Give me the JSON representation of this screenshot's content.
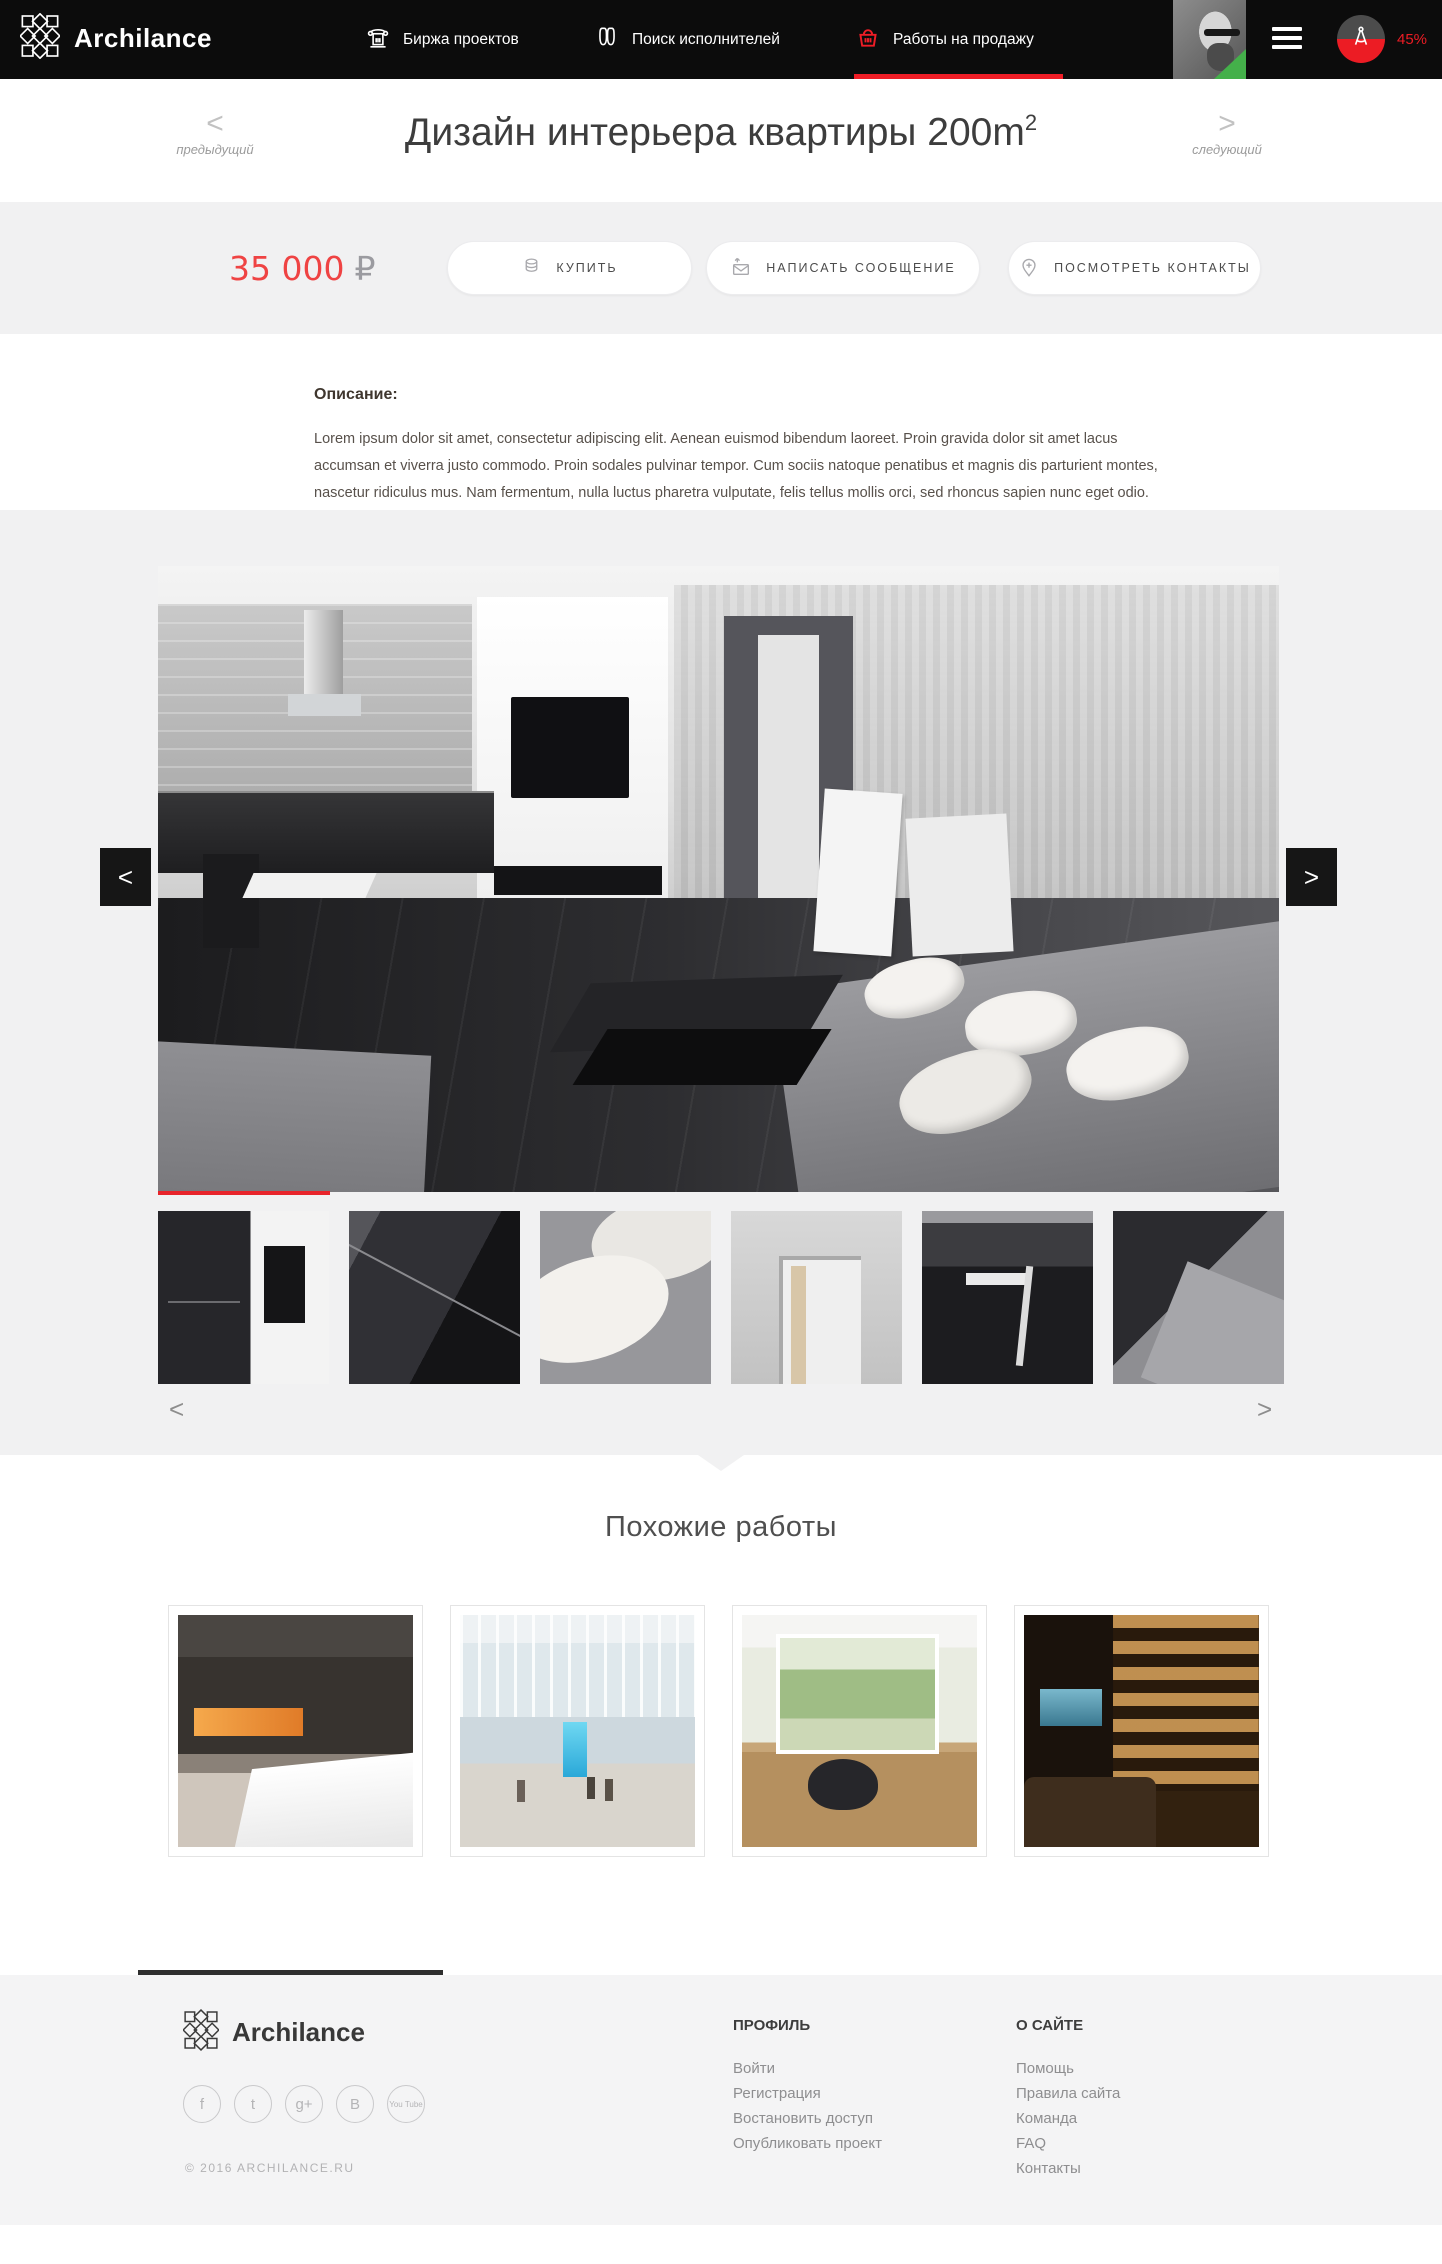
{
  "colors": {
    "accent_red": "#f01d26",
    "price_red": "#ef4343",
    "header_bg": "#0c0c0c",
    "section_gray": "#f1f1f2",
    "footer_gray": "#f4f4f5"
  },
  "header": {
    "brand": "Archilance",
    "nav": [
      {
        "label": "Биржа проектов",
        "icon": "bank-icon"
      },
      {
        "label": "Поиск исполнителей",
        "icon": "binoculars-icon"
      },
      {
        "label": "Работы на продажу",
        "icon": "basket-icon",
        "active": true
      }
    ],
    "progress_badge": "45%"
  },
  "title_bar": {
    "prev_arrow": "<",
    "prev_label": "предыдущий",
    "title": "Дизайн интерьера квартиры 200m",
    "title_sup": "2",
    "next_arrow": ">",
    "next_label": "следующий"
  },
  "purchase": {
    "price": "35 000",
    "currency": "₽",
    "buy_label": "КУПИТЬ",
    "message_label": "НАПИСАТЬ СООБЩЕНИЕ",
    "contacts_label": "ПОСМОТРЕТЬ КОНТАКТЫ"
  },
  "description": {
    "heading": "Описание:",
    "body": "Lorem ipsum dolor sit amet, consectetur adipiscing elit. Aenean euismod bibendum laoreet. Proin gravida dolor sit amet lacus accumsan et viverra justo commodo. Proin sodales pulvinar tempor. Cum sociis natoque penatibus et magnis dis parturient montes, nascetur ridiculus mus. Nam fermentum, nulla luctus pharetra vulputate, felis tellus mollis orci, sed rhoncus sapien nunc eget odio."
  },
  "gallery": {
    "prev_arrow": "<",
    "next_arrow": ">",
    "thumb_prev": "<",
    "thumb_next": ">",
    "thumbnails": [
      "kitchen-detail",
      "coffee-table-detail",
      "sofa-pillows-detail",
      "doorway-detail",
      "dining-area-detail",
      "sofa-floor-detail"
    ]
  },
  "similar": {
    "heading": "Похожие работы",
    "cards": [
      "fireplace-interior",
      "mall-atrium",
      "bright-living-room",
      "home-library"
    ]
  },
  "footer": {
    "brand": "Archilance",
    "copyright": "© 2016 ARCHILANCE.RU",
    "social": [
      {
        "name": "facebook",
        "glyph": "f"
      },
      {
        "name": "twitter",
        "glyph": "t"
      },
      {
        "name": "google-plus",
        "glyph": "g+"
      },
      {
        "name": "vk",
        "glyph": "B"
      },
      {
        "name": "youtube",
        "glyph": "You Tube"
      }
    ],
    "columns": [
      {
        "heading": "ПРОФИЛЬ",
        "links": [
          "Войти",
          "Регистрация",
          "Востановить доступ",
          "Опубликовать проект"
        ]
      },
      {
        "heading": "О САЙТЕ",
        "links": [
          "Помощь",
          "Правила сайта",
          "Команда",
          "FAQ",
          "Контакты"
        ]
      }
    ]
  }
}
